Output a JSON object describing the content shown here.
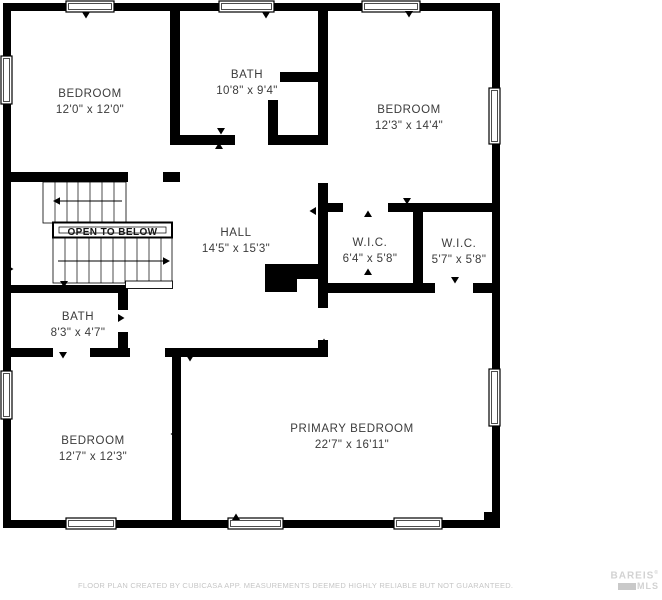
{
  "rooms": [
    {
      "name": "BEDROOM",
      "dims": "12'0\" x 12'0\"",
      "cx": 90,
      "cy": 97
    },
    {
      "name": "BATH",
      "dims": "10'8\" x 9'4\"",
      "cx": 247,
      "cy": 78
    },
    {
      "name": "BEDROOM",
      "dims": "12'3\" x 14'4\"",
      "cx": 409,
      "cy": 113
    },
    {
      "name": "HALL",
      "dims": "14'5\" x 15'3\"",
      "cx": 236,
      "cy": 236
    },
    {
      "name": "W.I.C.",
      "dims": "6'4\" x 5'8\"",
      "cx": 370,
      "cy": 246
    },
    {
      "name": "W.I.C.",
      "dims": "5'7\" x 5'8\"",
      "cx": 459,
      "cy": 247
    },
    {
      "name": "BATH",
      "dims": "8'3\" x 4'7\"",
      "cx": 78,
      "cy": 320
    },
    {
      "name": "BEDROOM",
      "dims": "12'7\" x 12'3\"",
      "cx": 93,
      "cy": 444
    },
    {
      "name": "PRIMARY BEDROOM",
      "dims": "22'7\" x 16'11\"",
      "cx": 352,
      "cy": 432
    }
  ],
  "stairs_label": "OPEN TO BELOW",
  "footer": {
    "disclaimer": "FLOOR PLAN CREATED BY CUBICASA APP. MEASUREMENTS DEEMED HIGHLY RELIABLE BUT NOT GUARANTEED."
  },
  "watermark": {
    "line1": "BAREIS",
    "reg": "®",
    "line2": "MLS"
  },
  "colors": {
    "wall": "#000000",
    "label": "#3b3b3b",
    "disclaimer": "#c6c6c6",
    "watermark": "#d2d2d2"
  },
  "plan": {
    "walls": [
      [
        3,
        3,
        497,
        8
      ],
      [
        3,
        3,
        8,
        525
      ],
      [
        492,
        3,
        8,
        525
      ],
      [
        3,
        520,
        497,
        8
      ],
      [
        484,
        512,
        16,
        16
      ],
      [
        170,
        3,
        10,
        142
      ],
      [
        170,
        135,
        65,
        10
      ],
      [
        268,
        100,
        10,
        45
      ],
      [
        268,
        135,
        52,
        10
      ],
      [
        280,
        72,
        40,
        10
      ],
      [
        318,
        3,
        10,
        142
      ],
      [
        318,
        183,
        10,
        125
      ],
      [
        318,
        340,
        10,
        17
      ],
      [
        3,
        172,
        125,
        10
      ],
      [
        163,
        172,
        17,
        10
      ],
      [
        328,
        203,
        15,
        9
      ],
      [
        388,
        203,
        104,
        9
      ],
      [
        413,
        203,
        10,
        90
      ],
      [
        318,
        283,
        117,
        10
      ],
      [
        473,
        283,
        19,
        10
      ],
      [
        3,
        348,
        50,
        9
      ],
      [
        90,
        348,
        40,
        9
      ],
      [
        165,
        348,
        155,
        9
      ],
      [
        118,
        285,
        10,
        25
      ],
      [
        118,
        332,
        10,
        25
      ],
      [
        3,
        285,
        120,
        8
      ],
      [
        172,
        348,
        9,
        172
      ],
      [
        265,
        264,
        32,
        28
      ],
      [
        297,
        264,
        23,
        15
      ]
    ],
    "windows": [
      [
        66,
        1,
        48,
        11
      ],
      [
        219,
        1,
        55,
        11
      ],
      [
        362,
        1,
        58,
        11
      ],
      [
        1,
        56,
        11,
        48
      ],
      [
        1,
        371,
        11,
        48
      ],
      [
        489,
        88,
        11,
        56
      ],
      [
        489,
        369,
        11,
        57
      ],
      [
        66,
        518,
        50,
        11
      ],
      [
        228,
        518,
        55,
        11
      ],
      [
        394,
        518,
        48,
        11
      ]
    ],
    "arrows": [
      [
        86,
        15,
        "down"
      ],
      [
        266,
        15,
        "down"
      ],
      [
        409,
        14,
        "down"
      ],
      [
        87,
        176,
        "down"
      ],
      [
        221,
        131,
        "down"
      ],
      [
        219,
        146,
        "up"
      ],
      [
        313,
        211,
        "left"
      ],
      [
        368,
        214,
        "up"
      ],
      [
        407,
        201,
        "down"
      ],
      [
        368,
        272,
        "up"
      ],
      [
        455,
        280,
        "down"
      ],
      [
        324,
        342,
        "up"
      ],
      [
        121,
        318,
        "right"
      ],
      [
        64,
        284,
        "down"
      ],
      [
        63,
        355,
        "down"
      ],
      [
        190,
        358,
        "down"
      ],
      [
        10,
        269,
        "right"
      ],
      [
        174,
        434,
        "left"
      ],
      [
        236,
        517,
        "up"
      ]
    ],
    "stairs": {
      "upper": {
        "box": [
          43,
          182,
          83,
          41
        ],
        "treads": [
          55,
          67,
          78,
          90,
          102,
          114
        ],
        "dir": {
          "y": 201,
          "x1": 60,
          "x2": 122,
          "tip": 53,
          "side": "left"
        }
      },
      "otb": {
        "box": [
          53,
          222.5,
          119,
          15
        ],
        "inner": [
          59,
          227,
          107,
          6
        ],
        "tx": 112.5,
        "ty": 235
      },
      "lower": {
        "box": [
          53,
          238,
          119,
          45
        ],
        "treads": [
          65,
          77,
          89,
          101,
          113,
          125,
          137,
          149,
          161
        ],
        "dir": {
          "y": 261,
          "x1": 58,
          "x2": 163,
          "tip": 170,
          "side": "right"
        }
      },
      "landing": [
        125.5,
        281,
        47,
        7.5
      ]
    }
  }
}
